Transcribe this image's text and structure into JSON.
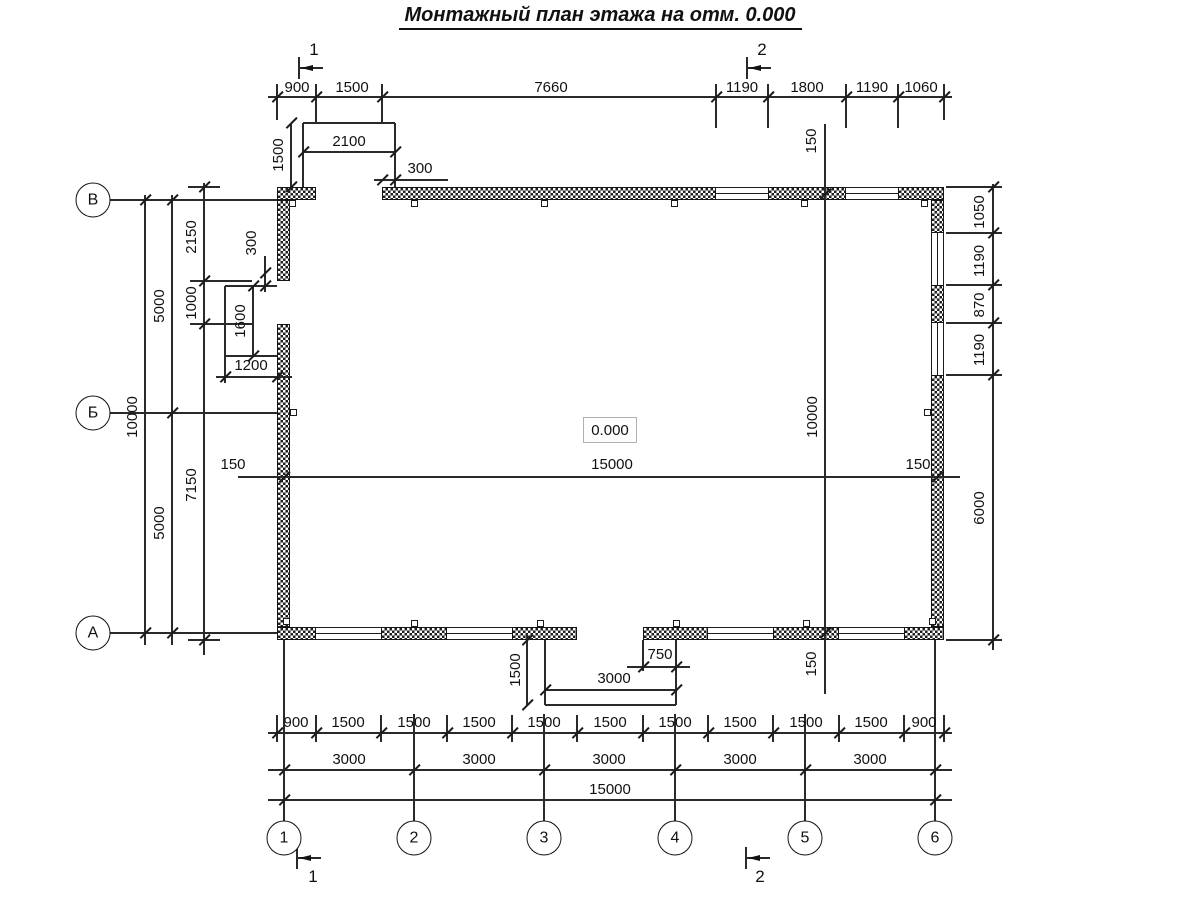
{
  "title": "Монтажный план этажа на отм. 0.000",
  "elevation_mark": "0.000",
  "axis_bubbles": {
    "horizontal": [
      "1",
      "2",
      "3",
      "4",
      "5",
      "6"
    ],
    "vertical": [
      "В",
      "Б",
      "А"
    ]
  },
  "section_marks": [
    "1",
    "2",
    "1",
    "2"
  ],
  "dimension_values": {
    "top_row": [
      "900",
      "1500",
      "7660",
      "1190",
      "1800",
      "1190",
      "1060"
    ],
    "bottom_row_1": [
      "900",
      "1500",
      "1500",
      "1500",
      "1500",
      "1500",
      "1500",
      "1500",
      "1500",
      "1500",
      "900"
    ],
    "bottom_row_2": [
      "3000",
      "3000",
      "3000",
      "3000",
      "3000"
    ],
    "bottom_row_3": [
      "15000"
    ],
    "left_column": [
      "2150",
      "1000",
      "7150",
      "5000",
      "5000",
      "10000"
    ],
    "right_column": [
      "1050",
      "1190",
      "870",
      "1190",
      "6000"
    ],
    "interior": [
      "150",
      "15000",
      "150",
      "150",
      "10000",
      "150"
    ],
    "top_porch": [
      "2100",
      "1500",
      "300"
    ],
    "left_porch": [
      "300",
      "1600",
      "1200"
    ],
    "bottom_porch": [
      "1500",
      "750",
      "3000"
    ]
  },
  "drawing": {
    "colors": {
      "line": "#2a2a2a",
      "text": "#111111",
      "wall_hatch": "#1f1f1f",
      "background": "#ffffff"
    },
    "labels": [
      {
        "t": "900",
        "x": 297,
        "y": 88
      },
      {
        "t": "1500",
        "x": 352,
        "y": 88
      },
      {
        "t": "7660",
        "x": 551,
        "y": 88
      },
      {
        "t": "1190",
        "x": 742,
        "y": 88
      },
      {
        "t": "1800",
        "x": 807,
        "y": 88
      },
      {
        "t": "1190",
        "x": 872,
        "y": 88
      },
      {
        "t": "1060",
        "x": 921,
        "y": 88
      },
      {
        "t": "2100",
        "x": 349,
        "y": 142
      },
      {
        "t": "1500",
        "x": 279,
        "y": 155,
        "r": 1
      },
      {
        "t": "300",
        "x": 420,
        "y": 169
      },
      {
        "t": "300",
        "x": 252,
        "y": 243,
        "r": 1
      },
      {
        "t": "1600",
        "x": 241,
        "y": 321,
        "r": 1
      },
      {
        "t": "1200",
        "x": 251,
        "y": 366
      },
      {
        "t": "2150",
        "x": 192,
        "y": 237,
        "r": 1
      },
      {
        "t": "1000",
        "x": 192,
        "y": 303,
        "r": 1
      },
      {
        "t": "7150",
        "x": 192,
        "y": 485,
        "r": 1
      },
      {
        "t": "5000",
        "x": 160,
        "y": 306,
        "r": 1
      },
      {
        "t": "5000",
        "x": 160,
        "y": 523,
        "r": 1
      },
      {
        "t": "10000",
        "x": 133,
        "y": 417,
        "r": 1
      },
      {
        "t": "150",
        "x": 233,
        "y": 465
      },
      {
        "t": "15000",
        "x": 612,
        "y": 465
      },
      {
        "t": "150",
        "x": 918,
        "y": 465
      },
      {
        "t": "10000",
        "x": 813,
        "y": 417,
        "r": 1
      },
      {
        "t": "150",
        "x": 812,
        "y": 141,
        "r": 1
      },
      {
        "t": "150",
        "x": 812,
        "y": 664,
        "r": 1
      },
      {
        "t": "1050",
        "x": 980,
        "y": 212,
        "r": 1
      },
      {
        "t": "1190",
        "x": 980,
        "y": 261,
        "r": 1
      },
      {
        "t": "870",
        "x": 980,
        "y": 305,
        "r": 1
      },
      {
        "t": "1190",
        "x": 980,
        "y": 350,
        "r": 1
      },
      {
        "t": "6000",
        "x": 980,
        "y": 508,
        "r": 1
      },
      {
        "t": "1500",
        "x": 516,
        "y": 670,
        "r": 1
      },
      {
        "t": "750",
        "x": 660,
        "y": 655
      },
      {
        "t": "3000",
        "x": 614,
        "y": 679
      },
      {
        "t": "900",
        "x": 296,
        "y": 723
      },
      {
        "t": "1500",
        "x": 348,
        "y": 723
      },
      {
        "t": "1500",
        "x": 414,
        "y": 723
      },
      {
        "t": "1500",
        "x": 479,
        "y": 723
      },
      {
        "t": "1500",
        "x": 544,
        "y": 723
      },
      {
        "t": "1500",
        "x": 610,
        "y": 723
      },
      {
        "t": "1500",
        "x": 675,
        "y": 723
      },
      {
        "t": "1500",
        "x": 740,
        "y": 723
      },
      {
        "t": "1500",
        "x": 806,
        "y": 723
      },
      {
        "t": "1500",
        "x": 871,
        "y": 723
      },
      {
        "t": "900",
        "x": 924,
        "y": 723
      },
      {
        "t": "3000",
        "x": 349,
        "y": 760
      },
      {
        "t": "3000",
        "x": 479,
        "y": 760
      },
      {
        "t": "3000",
        "x": 609,
        "y": 760
      },
      {
        "t": "3000",
        "x": 740,
        "y": 760
      },
      {
        "t": "3000",
        "x": 870,
        "y": 760
      },
      {
        "t": "15000",
        "x": 610,
        "y": 790
      },
      {
        "t": "1",
        "x": 314,
        "y": 50,
        "s": 1
      },
      {
        "t": "2",
        "x": 762,
        "y": 50,
        "s": 1
      },
      {
        "t": "1",
        "x": 313,
        "y": 877,
        "s": 1
      },
      {
        "t": "2",
        "x": 760,
        "y": 877,
        "s": 1
      }
    ],
    "lines": [
      [
        268,
        97,
        952,
        97
      ],
      [
        268,
        733,
        952,
        733
      ],
      [
        268,
        770,
        952,
        770
      ],
      [
        268,
        800,
        952,
        800
      ],
      [
        110,
        200,
        277,
        200
      ],
      [
        110,
        413,
        277,
        413
      ],
      [
        110,
        633,
        277,
        633
      ],
      [
        145,
        195,
        145,
        645
      ],
      [
        172,
        195,
        172,
        645
      ],
      [
        204,
        183,
        204,
        655
      ],
      [
        993,
        184,
        993,
        650
      ],
      [
        825,
        124,
        825,
        694
      ],
      [
        238,
        477,
        960,
        477
      ],
      [
        303,
        152,
        395,
        152
      ],
      [
        374,
        180,
        448,
        180
      ],
      [
        291,
        123,
        291,
        187
      ],
      [
        303,
        123,
        395,
        123
      ],
      [
        303,
        123,
        303,
        187
      ],
      [
        395,
        123,
        395,
        187
      ],
      [
        225,
        286,
        277,
        286
      ],
      [
        225,
        286,
        225,
        356
      ],
      [
        225,
        356,
        277,
        356
      ],
      [
        253,
        286,
        253,
        356
      ],
      [
        265,
        256,
        265,
        292
      ],
      [
        216,
        377,
        292,
        377
      ],
      [
        225,
        356,
        225,
        383
      ],
      [
        188,
        187,
        220,
        187
      ],
      [
        190,
        281,
        252,
        281
      ],
      [
        190,
        324,
        252,
        324
      ],
      [
        188,
        640,
        220,
        640
      ],
      [
        946,
        187,
        1002,
        187
      ],
      [
        946,
        233,
        1002,
        233
      ],
      [
        946,
        285,
        1002,
        285
      ],
      [
        946,
        323,
        1002,
        323
      ],
      [
        946,
        375,
        1002,
        375
      ],
      [
        946,
        640,
        1002,
        640
      ],
      [
        545,
        640,
        545,
        705
      ],
      [
        676,
        640,
        676,
        705
      ],
      [
        545,
        705,
        676,
        705
      ],
      [
        545,
        690,
        676,
        690
      ],
      [
        627,
        667,
        690,
        667
      ],
      [
        643,
        640,
        643,
        671
      ],
      [
        527,
        634,
        527,
        705
      ],
      [
        284,
        640,
        284,
        821
      ],
      [
        935,
        640,
        935,
        821
      ],
      [
        414,
        714,
        414,
        821
      ],
      [
        544,
        714,
        544,
        821
      ],
      [
        675,
        714,
        675,
        821
      ],
      [
        805,
        714,
        805,
        821
      ],
      [
        277,
        84,
        277,
        120
      ],
      [
        316,
        84,
        316,
        123
      ],
      [
        382,
        84,
        382,
        123
      ],
      [
        716,
        84,
        716,
        128
      ],
      [
        768,
        84,
        768,
        128
      ],
      [
        846,
        84,
        846,
        128
      ],
      [
        898,
        84,
        898,
        128
      ],
      [
        944,
        84,
        944,
        120
      ],
      [
        277,
        715,
        277,
        742
      ],
      [
        316,
        715,
        316,
        742
      ],
      [
        381,
        715,
        381,
        742
      ],
      [
        447,
        715,
        447,
        742
      ],
      [
        512,
        715,
        512,
        742
      ],
      [
        577,
        715,
        577,
        742
      ],
      [
        643,
        715,
        643,
        742
      ],
      [
        708,
        715,
        708,
        742
      ],
      [
        773,
        715,
        773,
        742
      ],
      [
        839,
        715,
        839,
        742
      ],
      [
        904,
        715,
        904,
        742
      ],
      [
        944,
        715,
        944,
        742
      ],
      [
        299,
        57,
        299,
        79
      ],
      [
        747,
        57,
        747,
        79
      ],
      [
        297,
        847,
        297,
        869
      ],
      [
        746,
        847,
        746,
        869
      ],
      [
        299,
        68,
        323,
        68
      ],
      [
        747,
        68,
        771,
        68
      ],
      [
        297,
        858,
        321,
        858
      ],
      [
        746,
        858,
        770,
        858
      ]
    ],
    "ticks": [
      [
        277,
        97
      ],
      [
        316,
        97
      ],
      [
        382,
        97
      ],
      [
        716,
        97
      ],
      [
        768,
        97
      ],
      [
        846,
        97
      ],
      [
        898,
        97
      ],
      [
        944,
        97
      ],
      [
        277,
        733
      ],
      [
        316,
        733
      ],
      [
        381,
        733
      ],
      [
        447,
        733
      ],
      [
        512,
        733
      ],
      [
        577,
        733
      ],
      [
        643,
        733
      ],
      [
        708,
        733
      ],
      [
        773,
        733
      ],
      [
        839,
        733
      ],
      [
        904,
        733
      ],
      [
        944,
        733
      ],
      [
        284,
        770
      ],
      [
        414,
        770
      ],
      [
        544,
        770
      ],
      [
        675,
        770
      ],
      [
        805,
        770
      ],
      [
        935,
        770
      ],
      [
        284,
        800
      ],
      [
        935,
        800
      ],
      [
        303,
        152
      ],
      [
        395,
        152
      ],
      [
        382,
        180
      ],
      [
        395,
        180
      ],
      [
        291,
        123
      ],
      [
        291,
        187
      ],
      [
        225,
        377
      ],
      [
        277,
        377
      ],
      [
        253,
        286
      ],
      [
        253,
        356
      ],
      [
        265,
        273
      ],
      [
        265,
        286
      ],
      [
        145,
        200
      ],
      [
        145,
        633
      ],
      [
        172,
        200
      ],
      [
        172,
        413
      ],
      [
        172,
        633
      ],
      [
        204,
        187
      ],
      [
        204,
        281
      ],
      [
        204,
        324
      ],
      [
        204,
        640
      ],
      [
        993,
        187
      ],
      [
        993,
        233
      ],
      [
        993,
        285
      ],
      [
        993,
        323
      ],
      [
        993,
        375
      ],
      [
        993,
        640
      ],
      [
        284,
        477
      ],
      [
        937,
        477
      ],
      [
        825,
        194
      ],
      [
        825,
        633
      ],
      [
        545,
        690
      ],
      [
        676,
        690
      ],
      [
        643,
        667
      ],
      [
        676,
        667
      ],
      [
        527,
        640
      ],
      [
        527,
        705
      ]
    ],
    "walls": [
      [
        277,
        187,
        39,
        13
      ],
      [
        382,
        187,
        334,
        13
      ],
      [
        768,
        187,
        78,
        13
      ],
      [
        898,
        187,
        46,
        13
      ],
      [
        277,
        627,
        39,
        13
      ],
      [
        381,
        627,
        66,
        13
      ],
      [
        512,
        627,
        65,
        13
      ],
      [
        643,
        627,
        65,
        13
      ],
      [
        773,
        627,
        66,
        13
      ],
      [
        904,
        627,
        40,
        13
      ],
      [
        277,
        200,
        13,
        81
      ],
      [
        277,
        324,
        13,
        303
      ],
      [
        931,
        200,
        13,
        33
      ],
      [
        931,
        285,
        13,
        38
      ],
      [
        931,
        375,
        13,
        252
      ]
    ],
    "windows": [
      [
        716,
        187,
        52,
        13,
        "h"
      ],
      [
        846,
        187,
        52,
        13,
        "h"
      ],
      [
        316,
        627,
        65,
        13,
        "h"
      ],
      [
        447,
        627,
        65,
        13,
        "h"
      ],
      [
        708,
        627,
        65,
        13,
        "h"
      ],
      [
        839,
        627,
        65,
        13,
        "h"
      ],
      [
        931,
        233,
        13,
        52,
        "v"
      ],
      [
        931,
        323,
        13,
        52,
        "v"
      ]
    ],
    "squares": [
      [
        411,
        200
      ],
      [
        541,
        200
      ],
      [
        671,
        200
      ],
      [
        801,
        200
      ],
      [
        411,
        620
      ],
      [
        537,
        620
      ],
      [
        673,
        620
      ],
      [
        803,
        620
      ],
      [
        290,
        409
      ],
      [
        924,
        409
      ],
      [
        289,
        200
      ],
      [
        921,
        200
      ],
      [
        283,
        618
      ],
      [
        929,
        618
      ]
    ],
    "arrows": [
      [
        301,
        68
      ],
      [
        749,
        68
      ],
      [
        299,
        858
      ],
      [
        748,
        858
      ]
    ],
    "bubbles": [
      {
        "t": "В",
        "x": 93,
        "y": 200
      },
      {
        "t": "Б",
        "x": 93,
        "y": 413
      },
      {
        "t": "А",
        "x": 93,
        "y": 633
      },
      {
        "t": "1",
        "x": 284,
        "y": 838
      },
      {
        "t": "2",
        "x": 414,
        "y": 838
      },
      {
        "t": "3",
        "x": 544,
        "y": 838
      },
      {
        "t": "4",
        "x": 675,
        "y": 838
      },
      {
        "t": "5",
        "x": 805,
        "y": 838
      },
      {
        "t": "6",
        "x": 935,
        "y": 838
      }
    ]
  }
}
